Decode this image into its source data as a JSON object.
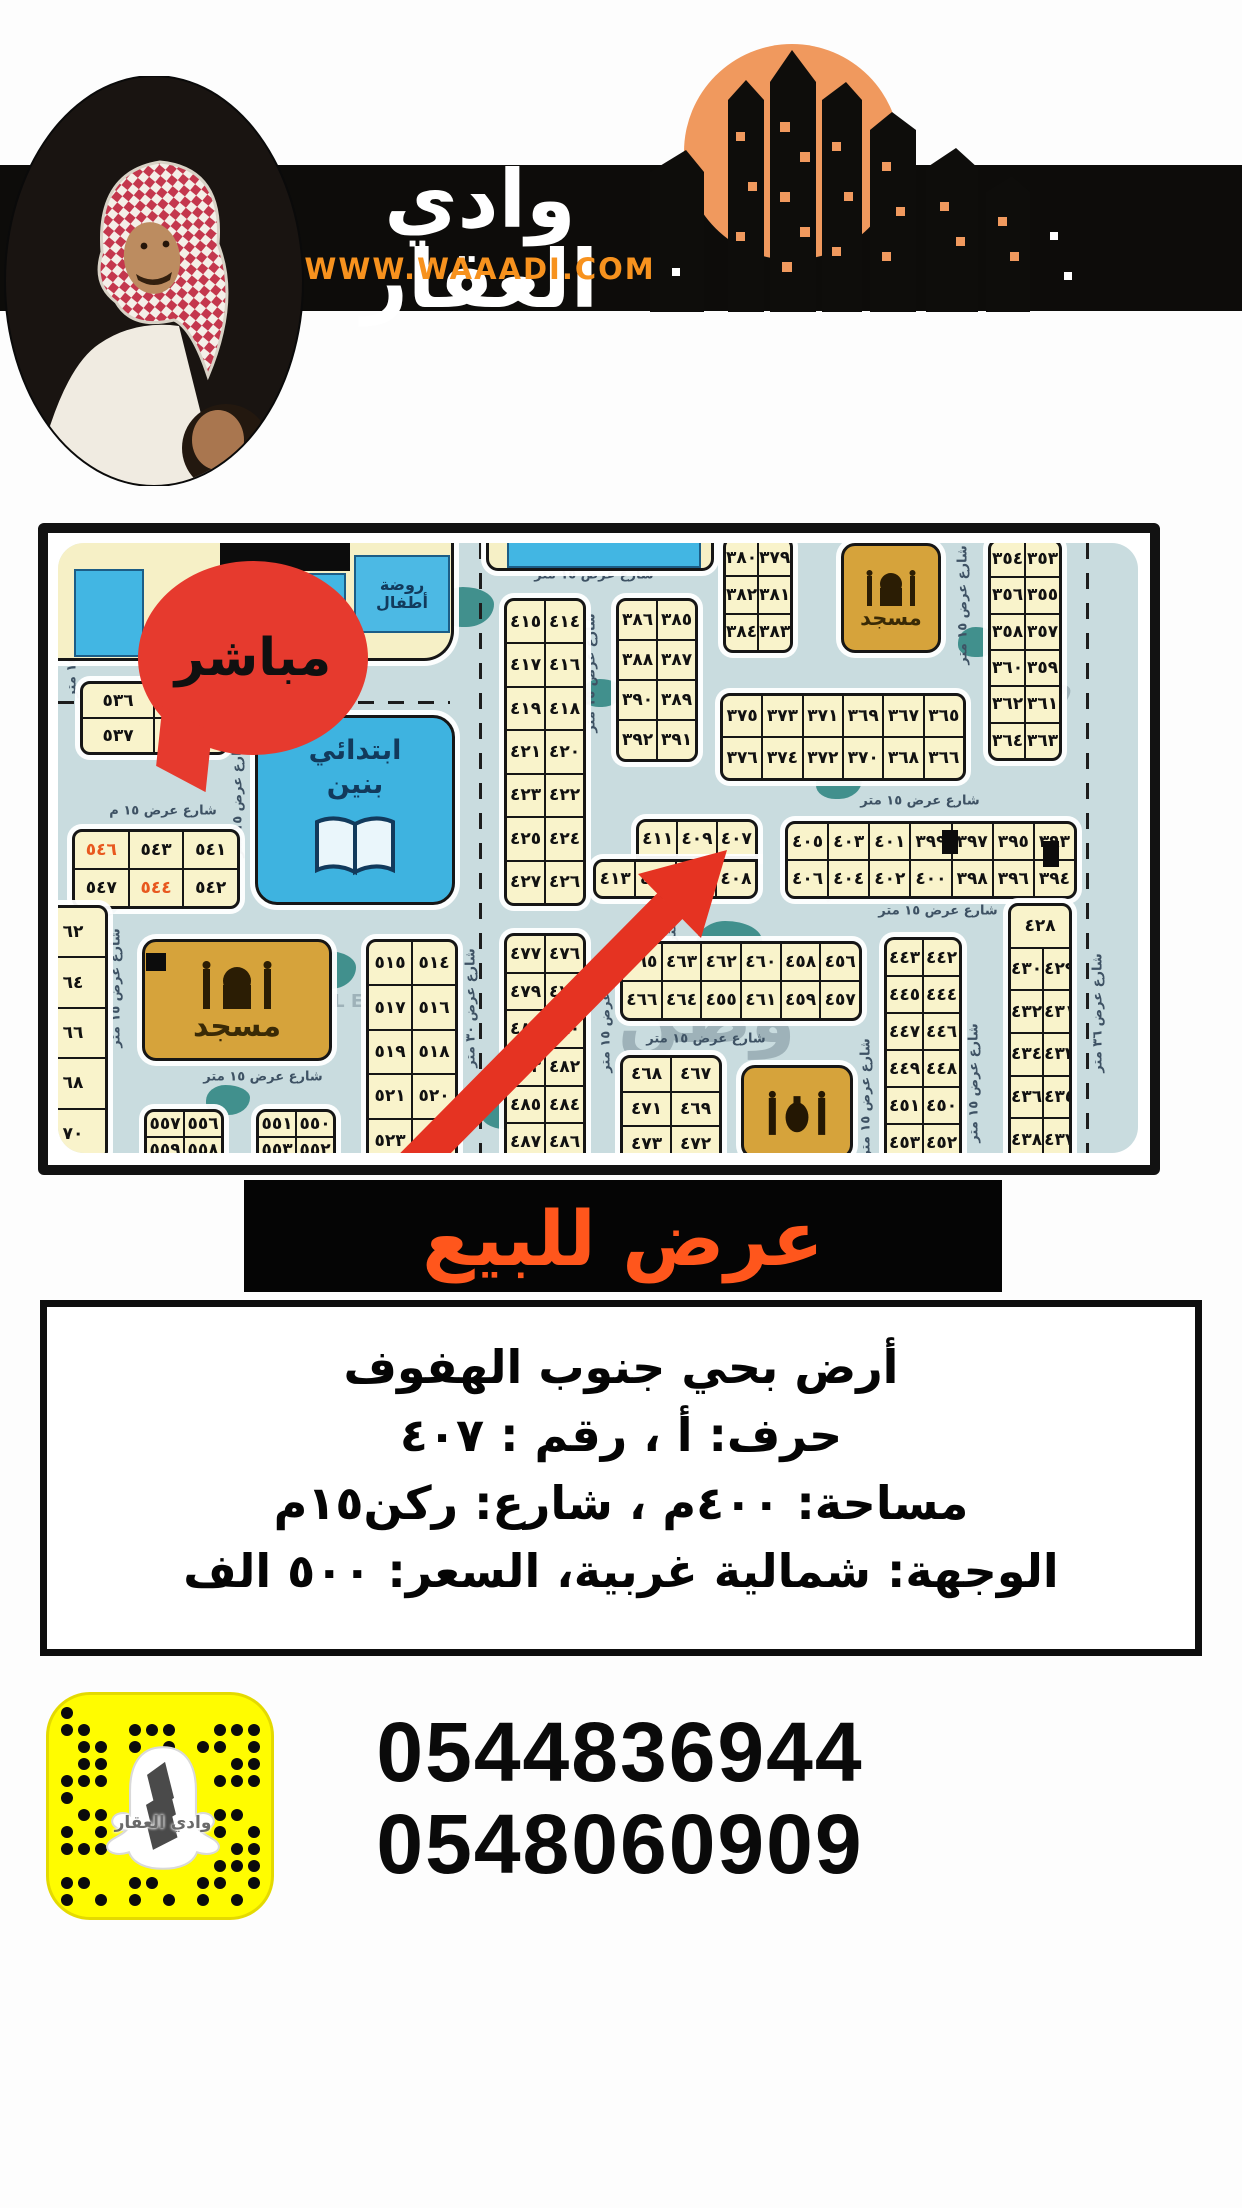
{
  "header": {
    "brand_name": "وادي العقار",
    "website": "WWW.WAAADI.COM"
  },
  "map": {
    "bubble_label": "مباشر",
    "school_label": "ابتدائي بنين",
    "kindergarten_label": "روضة أطفال",
    "mosque1_label": "مسجد",
    "mosque2_label": "مسجد",
    "street_label_default": "شارع عرض ١٥ متر",
    "street_labels": [
      {
        "x": 536,
        "y": 32,
        "v": false,
        "text": "شارع عرض ١٥ متر"
      },
      {
        "x": 105,
        "y": 268,
        "v": false,
        "text": "شارع عرض ١٥ م"
      },
      {
        "x": 862,
        "y": 258,
        "v": false,
        "text": "شارع عرض ١٥ متر"
      },
      {
        "x": 880,
        "y": 368,
        "v": false,
        "text": "شارع عرض ١٥ متر"
      },
      {
        "x": 205,
        "y": 534,
        "v": false,
        "text": "شارع عرض ١٥ متر"
      },
      {
        "x": 648,
        "y": 496,
        "v": false,
        "text": "شارع عرض ١٥ متر"
      },
      {
        "x": 533,
        "y": 130,
        "v": true,
        "text": "شارع عرض ١٥ متر"
      },
      {
        "x": 180,
        "y": 255,
        "v": true,
        "text": "شارع عرض ١٥ متر"
      },
      {
        "x": 14,
        "y": 95,
        "v": true,
        "text": "شارع عرض ١٥ متر"
      },
      {
        "x": 58,
        "y": 445,
        "v": true,
        "text": "شارع عرض ١٥ متر"
      },
      {
        "x": 905,
        "y": 62,
        "v": true,
        "text": "شارع عرض ١٥ متر"
      },
      {
        "x": 548,
        "y": 470,
        "v": true,
        "text": "شارع عرض ١٥ متر"
      },
      {
        "x": 808,
        "y": 555,
        "v": true,
        "text": "شارع عرض ١٥ متر"
      },
      {
        "x": 916,
        "y": 540,
        "v": true,
        "text": "شارع عرض ١٥ متر"
      },
      {
        "x": 614,
        "y": 340,
        "v": true,
        "text": "شارع عرض ١٥ متر"
      },
      {
        "x": 1040,
        "y": 470,
        "v": true,
        "text": "شارع عرض ٣٦ متر"
      },
      {
        "x": 413,
        "y": 465,
        "v": true,
        "text": "شارع عرض ٣٠ متر"
      }
    ],
    "watermarks": [
      {
        "x": 95,
        "y": 150,
        "rot": -35,
        "size": 26,
        "text": "وطن للعقار"
      },
      {
        "x": 560,
        "y": 432,
        "rot": 0,
        "size": 72,
        "text": "وطن"
      },
      {
        "x": 235,
        "y": 448,
        "rot": 0,
        "size": 18,
        "text": "REAL ESTATE"
      },
      {
        "x": 752,
        "y": 300,
        "rot": -35,
        "size": 22,
        "text": "وطن للعقار"
      },
      {
        "x": 152,
        "y": 128,
        "rot": -20,
        "size": 24,
        "text": "العقار"
      },
      {
        "x": 965,
        "y": 150,
        "rot": -60,
        "size": 22,
        "text": "وطن"
      }
    ],
    "blocks": [
      {
        "x": 22,
        "y": 138,
        "w": 148,
        "h": 74,
        "rows": [
          [
            "٥٣٦",
            "٥٣٤"
          ],
          [
            "٥٣٧",
            "٥٣٥"
          ]
        ]
      },
      {
        "x": 14,
        "y": 286,
        "w": 168,
        "h": 80,
        "rows": [
          [
            "٥٤٦",
            "٥٤٣",
            "٥٤١"
          ],
          [
            "٥٤٧",
            "٥٤٤",
            "٥٤٢"
          ]
        ],
        "hl": [
          "٥٤٦",
          "٥٤٤"
        ]
      },
      {
        "x": -20,
        "y": 362,
        "w": 70,
        "h": 256,
        "rows": [
          [
            "٦٢"
          ],
          [
            "٦٤"
          ],
          [
            "٦٦"
          ],
          [
            "٦٨"
          ],
          [
            "٧٠"
          ]
        ]
      },
      {
        "x": 86,
        "y": 566,
        "w": 80,
        "h": 56,
        "rows": [
          [
            "٥٥٧",
            "٥٥٦"
          ],
          [
            "٥٥٩",
            "٥٥٨"
          ]
        ]
      },
      {
        "x": 198,
        "y": 566,
        "w": 80,
        "h": 56,
        "rows": [
          [
            "٥٥١",
            "٥٥٠"
          ],
          [
            "٥٥٣",
            "٥٥٢"
          ]
        ]
      },
      {
        "x": 308,
        "y": 396,
        "w": 92,
        "h": 226,
        "rows": [
          [
            "٥١٥",
            "٥١٤"
          ],
          [
            "٥١٧",
            "٥١٦"
          ],
          [
            "٥١٩",
            "٥١٨"
          ],
          [
            "٥٢١",
            "٥٢٠"
          ],
          [
            "٥٢٣",
            "٥٢٢"
          ]
        ]
      },
      {
        "x": 446,
        "y": 55,
        "w": 82,
        "h": 308,
        "rows": [
          [
            "٤١٥",
            "٤١٤"
          ],
          [
            "٤١٧",
            "٤١٦"
          ],
          [
            "٤١٩",
            "٤١٨"
          ],
          [
            "٤٢١",
            "٤٢٠"
          ],
          [
            "٤٢٣",
            "٤٢٢"
          ],
          [
            "٤٢٥",
            "٤٢٤"
          ],
          [
            "٤٢٧",
            "٤٢٦"
          ]
        ]
      },
      {
        "x": 558,
        "y": 55,
        "w": 82,
        "h": 164,
        "rows": [
          [
            "٣٨٦",
            "٣٨٥"
          ],
          [
            "٣٨٨",
            "٣٨٧"
          ],
          [
            "٣٩٠",
            "٣٨٩"
          ],
          [
            "٣٩٢",
            "٣٩١"
          ]
        ]
      },
      {
        "x": 665,
        "y": -6,
        "w": 70,
        "h": 116,
        "rows": [
          [
            "٣٨٠",
            "٣٧٩"
          ],
          [
            "٣٨٢",
            "٣٨١"
          ],
          [
            "٣٨٤",
            "٣٨٣"
          ]
        ]
      },
      {
        "x": 930,
        "y": -4,
        "w": 74,
        "h": 222,
        "rows": [
          [
            "٣٥٤",
            "٣٥٣"
          ],
          [
            "٣٥٦",
            "٣٥٥"
          ],
          [
            "٣٥٨",
            "٣٥٧"
          ],
          [
            "٣٦٠",
            "٣٥٩"
          ],
          [
            "٣٦٢",
            "٣٦١"
          ],
          [
            "٣٦٤",
            "٣٦٣"
          ]
        ]
      },
      {
        "x": 662,
        "y": 150,
        "w": 246,
        "h": 88,
        "rows": [
          [
            "٣٧٥",
            "٣٧٣",
            "٣٧١",
            "٣٦٩",
            "٣٦٧",
            "٣٦٥"
          ],
          [
            "٣٧٦",
            "٣٧٤",
            "٣٧٢",
            "٣٧٠",
            "٣٦٨",
            "٣٦٦"
          ]
        ]
      },
      {
        "x": 578,
        "y": 276,
        "w": 122,
        "h": 40,
        "r": "10px 10px 0 0",
        "rows": [
          [
            "٤١١",
            "٤٠٩",
            "٤٠٧"
          ]
        ]
      },
      {
        "x": 535,
        "y": 316,
        "w": 165,
        "h": 40,
        "r": "10px 0 10px 10px",
        "rows": [
          [
            "٤١٣",
            "٤١٢",
            "",
            "٤٠٨"
          ]
        ]
      },
      {
        "x": 727,
        "y": 278,
        "w": 292,
        "h": 78,
        "rows": [
          [
            "٤٠٥",
            "٤٠٣",
            "٤٠١",
            "٣٩٩",
            "٣٩٧",
            "٣٩٥",
            "٣٩٣"
          ],
          [
            "٤٠٦",
            "٤٠٤",
            "٤٠٢",
            "٤٠٠",
            "٣٩٨",
            "٣٩٦",
            "٣٩٤"
          ]
        ]
      },
      {
        "x": 446,
        "y": 390,
        "w": 82,
        "h": 230,
        "rows": [
          [
            "٤٧٧",
            "٤٧٦"
          ],
          [
            "٤٧٩",
            "٤٧٨"
          ],
          [
            "٤٨١",
            "٤٨٠"
          ],
          [
            "٤٨٣",
            "٤٨٢"
          ],
          [
            "٤٨٥",
            "٤٨٤"
          ],
          [
            "٤٨٧",
            "٤٨٦"
          ]
        ]
      },
      {
        "x": 562,
        "y": 398,
        "w": 242,
        "h": 80,
        "rows": [
          [
            "٤٦٥",
            "٤٦٣",
            "٤٦٢",
            "٤٦٠",
            "٤٥٨",
            "٤٥٦"
          ],
          [
            "٤٦٦",
            "٤٦٤",
            "٤٥٥",
            "٤٦١",
            "٤٥٩",
            "٤٥٧"
          ]
        ]
      },
      {
        "x": 562,
        "y": 512,
        "w": 102,
        "h": 108,
        "rows": [
          [
            "٤٦٨",
            "٤٦٧"
          ],
          [
            "٤٧١",
            "٤٦٩"
          ],
          [
            "٤٧٣",
            "٤٧٢"
          ]
        ]
      },
      {
        "x": 826,
        "y": 394,
        "w": 78,
        "h": 226,
        "rows": [
          [
            "٤٤٣",
            "٤٤٢"
          ],
          [
            "٤٤٥",
            "٤٤٤"
          ],
          [
            "٤٤٧",
            "٤٤٦"
          ],
          [
            "٤٤٩",
            "٤٤٨"
          ],
          [
            "٤٥١",
            "٤٥٠"
          ],
          [
            "٤٥٣",
            "٤٥٢"
          ]
        ]
      },
      {
        "x": 950,
        "y": 360,
        "w": 64,
        "h": 260,
        "rows": [
          [
            "٤٢٨"
          ],
          [
            "٤٣٠",
            "٤٢٩"
          ],
          [
            "٤٣٢",
            "٤٣١"
          ],
          [
            "٤٣٤",
            "٤٣٣"
          ],
          [
            "٤٣٦",
            "٤٣٥"
          ],
          [
            "٤٣٨",
            "٤٣٧"
          ]
        ]
      }
    ]
  },
  "banner": {
    "label": "عرض للبيع"
  },
  "details": {
    "line1": "أرض بحي جنوب الهفوف",
    "line2": "حرف: أ ، رقم : ٤٠٧",
    "line3": "مساحة: ٤٠٠م ، شارع: ركن١٥م",
    "line4": "الوجهة: شمالية غربية، السعر: ٥٠٠ الف"
  },
  "contact": {
    "phone1": "0544836944",
    "phone2": "0548060909",
    "snap_label": "وادي العقار"
  },
  "colors": {
    "accent_orange": "#f7921e",
    "logo_orange": "#f0995e",
    "banner_orange": "#ff561c",
    "bubble_red": "#e63a2e",
    "arrow_red": "#e53322",
    "map_bg": "#c9dcdf",
    "plot_fill": "#f9f3cb",
    "mosque_gold": "#d6a33b",
    "school_blue": "#3eb3e0",
    "snap_yellow": "#fffc00",
    "highlight_number": "#e8581f"
  }
}
